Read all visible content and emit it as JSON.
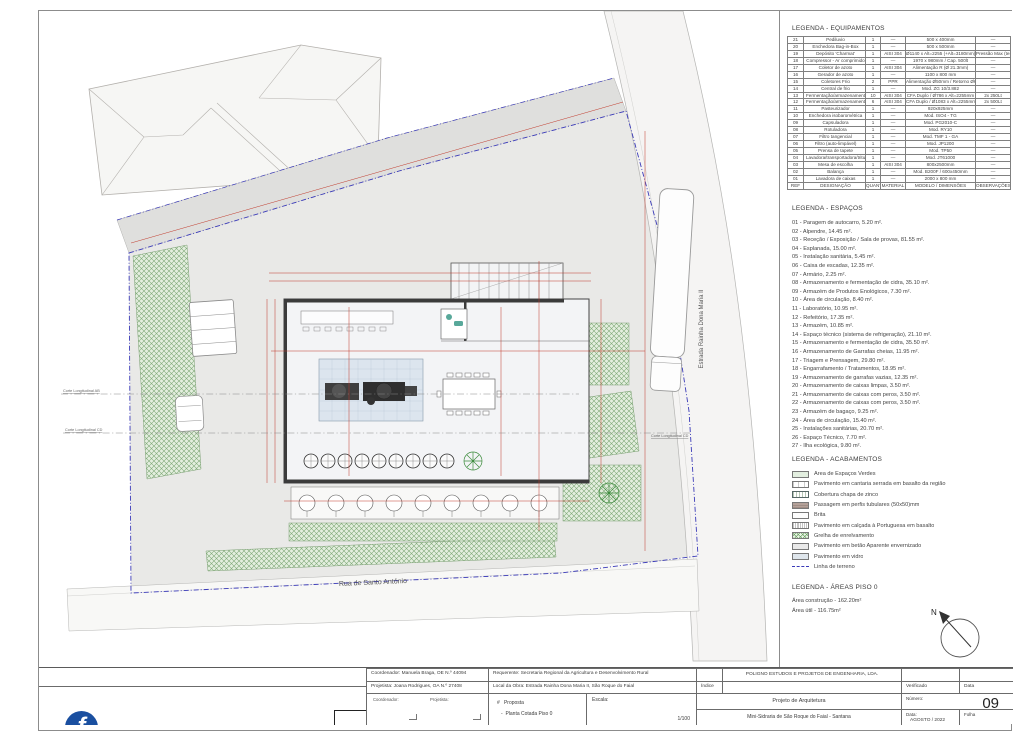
{
  "plan": {
    "street_bottom": "Rua de Santo António",
    "street_right": "Estrada Rainha Dona Maria II",
    "section_left_1": "Corte Longitudinal AB",
    "section_left_2": "Corte Longitudinal CD",
    "section_right": "Corte Longitudinal CD",
    "north": "N"
  },
  "legend_equipment": {
    "title": "LEGENDA - EQUIPAMENTOS",
    "header": [
      "REF",
      "DESIGNAÇÃO",
      "QUANT",
      "MATERIAL",
      "MODELO / DIMENSÕES",
      "OBSERVAÇÕES"
    ],
    "rows": [
      [
        "21",
        "Pediluvio",
        "1",
        "—",
        "500 x 400mm",
        "—"
      ],
      [
        "20",
        "Enchedora Bag-in-Box",
        "1",
        "—",
        "500 x 500mm",
        "—"
      ],
      [
        "19",
        "Depósito 'Charmat'",
        "1",
        "AISI 304",
        "Ø1140 x Alt=2255 (+Alt=3180mm)",
        "Pressão Max (teste)"
      ],
      [
        "18",
        "Compressor - Ar comprimido",
        "1",
        "—",
        "1970 x 980mm / Cap. 500lt",
        "—"
      ],
      [
        "17",
        "Coletor de azoto",
        "1",
        "AISI 304",
        "Alimentação R (Ø 21.3mm)",
        "—"
      ],
      [
        "16",
        "Gerador de azoto",
        "1",
        "—",
        "1100 x 800 mm",
        "—"
      ],
      [
        "15",
        "Coletores Frio",
        "2",
        "PPR",
        "Alimentação Ø50mm / Retorno Ø63mm",
        "—"
      ],
      [
        "14",
        "Central de frio",
        "1",
        "—",
        "Mod. ZG 10/3.882",
        "—"
      ],
      [
        "13",
        "Fermentação/armazenamento",
        "10",
        "AISI 304",
        "CFA Duplo / Ø786 x Alt=2255mm",
        "2x 250Lt"
      ],
      [
        "12",
        "Fermentação/armazenamento",
        "6",
        "AISI 304",
        "CFA Duplo / Ø1083 x Alt=2255mm",
        "2x 500Lt"
      ],
      [
        "11",
        "Pasteurizador",
        "1",
        "—",
        "920x925mm",
        "—"
      ],
      [
        "10",
        "Enchedora isobarométrica",
        "1",
        "—",
        "Mod. ISO4 - TG",
        "—"
      ],
      [
        "09",
        "Capsuladora",
        "1",
        "—",
        "Mod. PG2010-C",
        "—"
      ],
      [
        "08",
        "Rotuladora",
        "1",
        "—",
        "Mod. RY10",
        "—"
      ],
      [
        "07",
        "Filtro tangencial",
        "1",
        "—",
        "Mod. TMF 1 - GA",
        "—"
      ],
      [
        "06",
        "Filtro (auto-limpável)",
        "1",
        "—",
        "Mod. JP1200",
        "—"
      ],
      [
        "05",
        "Prensa de tapete",
        "1",
        "—",
        "Mod. TP50",
        "—"
      ],
      [
        "04",
        "Lavadora/transportadora/trituradora",
        "1",
        "—",
        "Mod. JT61000",
        "—"
      ],
      [
        "03",
        "Mesa de escolha",
        "1",
        "AISI 304",
        "800x2500mm",
        "—"
      ],
      [
        "02",
        "Balança",
        "1",
        "—",
        "Mod. B200F / 600x450mm",
        "—"
      ],
      [
        "01",
        "Lavadora de caixas",
        "1",
        "—",
        "2000 x 800 mm",
        "—"
      ]
    ]
  },
  "legend_spaces": {
    "title": "LEGENDA - ESPAÇOS",
    "items": [
      "01 - Paragem de autocarro, 5.20 m².",
      "02 - Alpendre, 14.45 m².",
      "03 - Receção / Exposição / Sala de provas, 81.55 m².",
      "04 - Esplanada, 15.00 m².",
      "05 - Instalação sanitária, 5.45 m².",
      "06 - Caixa de escadas, 12.35 m².",
      "07 - Armário, 2.25 m².",
      "08 - Armazenamento e fermentação de cidra, 35.10 m².",
      "09 - Armazém de Produtos Enológicos, 7.30 m².",
      "10 - Área de circulação, 8.40 m².",
      "11 - Laboratório, 10.95 m².",
      "12 - Refeitório, 17.35 m².",
      "13 - Armazém, 10.85 m².",
      "14 - Espaço técnico (sistema de refrigeração), 21.10 m².",
      "15 - Armazenamento e fermentação de cidra, 35.50 m².",
      "16 - Armazenamento de Garrafas cheias, 11.95 m².",
      "17 - Triagem e Prensagem, 29.80 m².",
      "18 - Engarrafamento / Tratamentos, 18.95 m².",
      "19 - Armazenamento de garrafas vazias, 12.35 m².",
      "20 - Armazenamento de caixas limpas, 3.50 m².",
      "21 - Armazenamento de caixas com peros, 3.50 m².",
      "22 - Armazenamento de caixas com peros, 3.50 m².",
      "23 - Armazém de bagaço, 9.25 m².",
      "24 - Área de circulação, 15.40 m².",
      "25 - Instalações sanitárias, 20.70 m².",
      "26 - Espaço Técnico, 7.70 m².",
      "27 - Ilha ecológica, 9.80 m²."
    ]
  },
  "legend_finishes": {
    "title": "LEGENDA - ACABAMENTOS",
    "items": [
      {
        "label": "Área de Espaços Verdes",
        "swatch": "sw-green"
      },
      {
        "label": "Pavimento em cantaria serrada em basalto da região",
        "swatch": "sw-stone"
      },
      {
        "label": "Cobertura chapa de zinco",
        "swatch": "sw-zinc"
      },
      {
        "label": "Passagem em perfis tubulares (50x50)mm",
        "swatch": "sw-tube"
      },
      {
        "label": "Brita",
        "swatch": "sw-brita"
      },
      {
        "label": "Pavimento em calçada à Portuguesa em basalto",
        "swatch": "sw-calcada"
      },
      {
        "label": "Grelha de enrelvamento",
        "swatch": "sw-grelha"
      },
      {
        "label": "Pavimento em betão Aparente envernizado",
        "swatch": "sw-betao"
      },
      {
        "label": "Pavimento em vidro",
        "swatch": "sw-vidro"
      },
      {
        "label": "Linha de terreno",
        "swatch": "sw-line"
      }
    ]
  },
  "legend_areas": {
    "title": "LEGENDA - ÁREAS PISO 0",
    "construction": "Área construção - 162.20m²",
    "useful": "Área útil - 116.75m²"
  },
  "titleblock": {
    "coordenador": "Coordenador: Manuela Braga, OE N.º 44094",
    "projetista": "Projetista: Joana Rodrigues, OA N.º 27408",
    "requerente": "Requerente: Secretaria Regional da Agricultura e Desenvolvimento Rural",
    "local_obra": "Local da Obra: Estrada Rainha Dona Maria II, São Roque do Faial",
    "sig_coordenador": "Coordenador:",
    "sig_projetista": "Projetista:",
    "proposta_mark": "#",
    "proposta": "Proposta",
    "desenho_mark": "-",
    "desenho": "Planta Cotada Piso 0",
    "escala_label": "Escala:",
    "escala_value": "1/100",
    "empresa": "POLIGNO ESTUDOS E PROJETOS DE ENGENHARIA, LDA.",
    "indice": "Índice",
    "verificado": "Verificado",
    "data_label": "Data",
    "projeto": "Projeto de Arquitetura",
    "numero_label": "Número:",
    "numero": "09",
    "obra": "Mini-Sidraria de São Roque do Faial - Santana",
    "data_label2": "Data:",
    "data_value": "AGOSTO / 2022",
    "folha": "Folha"
  },
  "logo": {
    "letter": "f",
    "name": "POLIGNO",
    "tagline": "ESTUDOS E PROJETOS DE ENGENHARIA, LDA",
    "address": "Rua Visconde do Anadia, n.º 19, 4.º Andar, Sala V, 9050-020 Funchal"
  },
  "colors": {
    "accent_blue": "#1a4fa0",
    "accent_red": "#c03a2b",
    "boundary_blue": "#3a3ab8",
    "dimension_red": "#c0392b",
    "green_hatch": "#6fa468"
  }
}
